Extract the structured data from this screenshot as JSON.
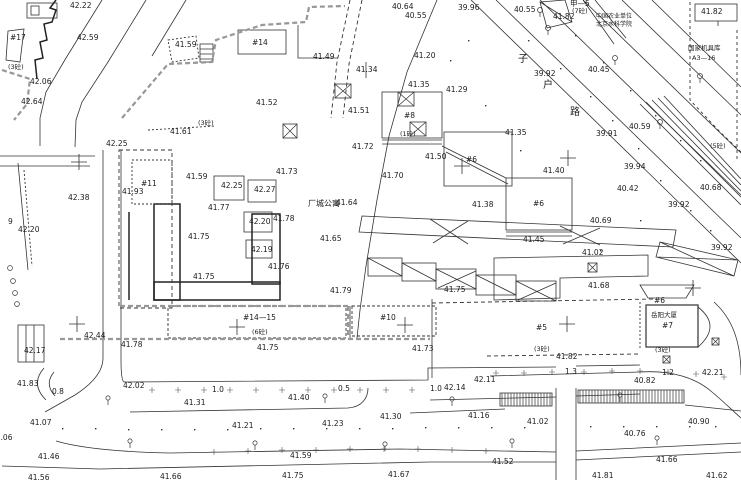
{
  "canvas": {
    "width": 741,
    "height": 480,
    "background": "#ffffff",
    "ink": "#222222"
  },
  "labels": {
    "spots": [
      {
        "t": "42.22",
        "x": 70,
        "y": 2
      },
      {
        "t": "40.64",
        "x": 392,
        "y": 3
      },
      {
        "t": "40.55",
        "x": 405,
        "y": 12
      },
      {
        "t": "39.96",
        "x": 458,
        "y": 4
      },
      {
        "t": "40.55",
        "x": 514,
        "y": 6
      },
      {
        "t": "41.82",
        "x": 553,
        "y": 13
      },
      {
        "t": "41.82",
        "x": 701,
        "y": 8
      },
      {
        "t": "42.59",
        "x": 77,
        "y": 34
      },
      {
        "t": "41.59",
        "x": 175,
        "y": 41
      },
      {
        "t": "42.06",
        "x": 30,
        "y": 78
      },
      {
        "t": "42.64",
        "x": 21,
        "y": 98
      },
      {
        "t": "41.61",
        "x": 170,
        "y": 128
      },
      {
        "t": "42.25",
        "x": 106,
        "y": 140
      },
      {
        "t": "41.49",
        "x": 313,
        "y": 53
      },
      {
        "t": "41.20",
        "x": 414,
        "y": 52
      },
      {
        "t": "41.34",
        "x": 356,
        "y": 66
      },
      {
        "t": "41.35",
        "x": 408,
        "y": 81
      },
      {
        "t": "41.29",
        "x": 446,
        "y": 86
      },
      {
        "t": "41.52",
        "x": 256,
        "y": 99
      },
      {
        "t": "41.51",
        "x": 348,
        "y": 107
      },
      {
        "t": "41.72",
        "x": 352,
        "y": 143
      },
      {
        "t": "41.50",
        "x": 425,
        "y": 153
      },
      {
        "t": "39.92",
        "x": 534,
        "y": 70
      },
      {
        "t": "40.45",
        "x": 588,
        "y": 66
      },
      {
        "t": "41.35",
        "x": 505,
        "y": 129
      },
      {
        "t": "39.91",
        "x": 596,
        "y": 130
      },
      {
        "t": "40.59",
        "x": 629,
        "y": 123
      },
      {
        "t": "41.93",
        "x": 122,
        "y": 188
      },
      {
        "t": "42.38",
        "x": 68,
        "y": 194
      },
      {
        "t": "42.20",
        "x": 18,
        "y": 226
      },
      {
        "t": "41.59",
        "x": 186,
        "y": 173
      },
      {
        "t": "42.25",
        "x": 221,
        "y": 182
      },
      {
        "t": "42.27",
        "x": 254,
        "y": 186
      },
      {
        "t": "41.77",
        "x": 208,
        "y": 204
      },
      {
        "t": "41.73",
        "x": 276,
        "y": 168
      },
      {
        "t": "41.70",
        "x": 382,
        "y": 172
      },
      {
        "t": "41.64",
        "x": 336,
        "y": 199
      },
      {
        "t": "41.78",
        "x": 273,
        "y": 215
      },
      {
        "t": "42.20",
        "x": 249,
        "y": 218
      },
      {
        "t": "42.19",
        "x": 251,
        "y": 246
      },
      {
        "t": "41.65",
        "x": 320,
        "y": 235
      },
      {
        "t": "41.76",
        "x": 268,
        "y": 263
      },
      {
        "t": "41.75",
        "x": 188,
        "y": 233
      },
      {
        "t": "41.75",
        "x": 193,
        "y": 273
      },
      {
        "t": "41.79",
        "x": 330,
        "y": 287
      },
      {
        "t": "41.75",
        "x": 444,
        "y": 286
      },
      {
        "t": "41.38",
        "x": 472,
        "y": 201
      },
      {
        "t": "41.40",
        "x": 543,
        "y": 167
      },
      {
        "t": "41.45",
        "x": 523,
        "y": 236
      },
      {
        "t": "40.69",
        "x": 590,
        "y": 217
      },
      {
        "t": "39.94",
        "x": 624,
        "y": 163
      },
      {
        "t": "40.42",
        "x": 617,
        "y": 185
      },
      {
        "t": "40.68",
        "x": 700,
        "y": 184
      },
      {
        "t": "39.92",
        "x": 668,
        "y": 201
      },
      {
        "t": "39.92",
        "x": 711,
        "y": 244
      },
      {
        "t": "41.02",
        "x": 582,
        "y": 249
      },
      {
        "t": "41.68",
        "x": 588,
        "y": 282
      },
      {
        "t": "42.17",
        "x": 24,
        "y": 347
      },
      {
        "t": "42.44",
        "x": 84,
        "y": 332
      },
      {
        "t": "41.78",
        "x": 121,
        "y": 341
      },
      {
        "t": "41.75",
        "x": 257,
        "y": 344
      },
      {
        "t": "41.73",
        "x": 412,
        "y": 345
      },
      {
        "t": "41.82",
        "x": 556,
        "y": 353
      },
      {
        "t": "41.83",
        "x": 17,
        "y": 380
      },
      {
        "t": "42.02",
        "x": 123,
        "y": 382
      },
      {
        "t": "41.31",
        "x": 184,
        "y": 399
      },
      {
        "t": "41.40",
        "x": 288,
        "y": 394
      },
      {
        "t": "42.14",
        "x": 444,
        "y": 384
      },
      {
        "t": "42.11",
        "x": 474,
        "y": 376
      },
      {
        "t": "40.82",
        "x": 634,
        "y": 377
      },
      {
        "t": "42.21",
        "x": 702,
        "y": 369
      },
      {
        "t": "41.07",
        "x": 30,
        "y": 419
      },
      {
        "t": "41.21",
        "x": 232,
        "y": 422
      },
      {
        "t": "41.23",
        "x": 322,
        "y": 420
      },
      {
        "t": "41.30",
        "x": 380,
        "y": 413
      },
      {
        "t": "41.16",
        "x": 468,
        "y": 412
      },
      {
        "t": "41.02",
        "x": 527,
        "y": 418
      },
      {
        "t": "40.76",
        "x": 624,
        "y": 430
      },
      {
        "t": "40.90",
        "x": 688,
        "y": 418
      },
      {
        "t": "41.06",
        "x": -9,
        "y": 434
      },
      {
        "t": "41.46",
        "x": 38,
        "y": 453
      },
      {
        "t": "41.56",
        "x": 28,
        "y": 474
      },
      {
        "t": "41.66",
        "x": 160,
        "y": 473
      },
      {
        "t": "41.59",
        "x": 290,
        "y": 452
      },
      {
        "t": "41.75",
        "x": 282,
        "y": 472
      },
      {
        "t": "41.67",
        "x": 388,
        "y": 471
      },
      {
        "t": "41.52",
        "x": 492,
        "y": 458
      },
      {
        "t": "41.66",
        "x": 656,
        "y": 456
      },
      {
        "t": "41.81",
        "x": 592,
        "y": 472
      },
      {
        "t": "41.62",
        "x": 706,
        "y": 472
      }
    ],
    "buildings": [
      {
        "t": "#17",
        "x": 10,
        "y": 34
      },
      {
        "t": "#14",
        "x": 252,
        "y": 39
      },
      {
        "t": "#8",
        "x": 404,
        "y": 112
      },
      {
        "t": "#6",
        "x": 466,
        "y": 156
      },
      {
        "t": "#6",
        "x": 533,
        "y": 200
      },
      {
        "t": "#11",
        "x": 141,
        "y": 180
      },
      {
        "t": "#14—15",
        "x": 243,
        "y": 314
      },
      {
        "t": "#10",
        "x": 380,
        "y": 314
      },
      {
        "t": "#5",
        "x": 536,
        "y": 324
      },
      {
        "t": "#7",
        "x": 662,
        "y": 322
      },
      {
        "t": "#6",
        "x": 654,
        "y": 297
      },
      {
        "t": "甲—5",
        "x": 570,
        "y": 0
      }
    ],
    "storeys": [
      {
        "t": "(3砼)",
        "x": 8,
        "y": 64
      },
      {
        "t": "(3砼)",
        "x": 198,
        "y": 120
      },
      {
        "t": "(7砼)",
        "x": 572,
        "y": 8
      },
      {
        "t": "(1砼)",
        "x": 400,
        "y": 131
      },
      {
        "t": "(5砼)",
        "x": 710,
        "y": 143
      },
      {
        "t": "(6砼)",
        "x": 252,
        "y": 329
      },
      {
        "t": "(3砼)",
        "x": 534,
        "y": 346
      },
      {
        "t": "(3砼)",
        "x": 655,
        "y": 347
      }
    ],
    "names": [
      {
        "t": "厂城公寓",
        "x": 308,
        "y": 200,
        "s": 8
      },
      {
        "t": "中国农业单位",
        "x": 596,
        "y": 14,
        "s": 6
      },
      {
        "t": "北京水科学院",
        "x": 596,
        "y": 22,
        "s": 6
      },
      {
        "t": "国家机具库",
        "x": 688,
        "y": 45,
        "s": 6.5
      },
      {
        "t": "A3—16",
        "x": 692,
        "y": 55,
        "s": 6.5
      },
      {
        "t": "岳阳大厦",
        "x": 651,
        "y": 312,
        "s": 6.5
      }
    ],
    "widths": [
      {
        "t": "0.8",
        "x": 52,
        "y": 388
      },
      {
        "t": "1.0",
        "x": 212,
        "y": 386
      },
      {
        "t": "0.5",
        "x": 338,
        "y": 385
      },
      {
        "t": "1.0",
        "x": 430,
        "y": 385
      },
      {
        "t": "1.3",
        "x": 565,
        "y": 368
      },
      {
        "t": "1.2",
        "x": 662,
        "y": 369
      }
    ],
    "road_chars": [
      {
        "t": "子",
        "x": 518,
        "y": 55
      },
      {
        "t": "户",
        "x": 543,
        "y": 81
      },
      {
        "t": "路",
        "x": 570,
        "y": 108
      }
    ],
    "misc": [
      {
        "t": "9",
        "x": 8,
        "y": 218
      }
    ]
  },
  "symbols": {
    "crosses": [
      [
        79,
        162
      ],
      [
        462,
        166
      ],
      [
        568,
        158
      ],
      [
        77,
        324
      ],
      [
        237,
        327
      ],
      [
        405,
        325
      ],
      [
        567,
        324
      ],
      [
        693,
        288
      ]
    ],
    "lamps": [
      [
        108,
        398
      ],
      [
        325,
        396
      ],
      [
        452,
        399
      ],
      [
        620,
        395
      ],
      [
        130,
        441
      ],
      [
        255,
        443
      ],
      [
        385,
        444
      ],
      [
        512,
        441
      ],
      [
        657,
        438
      ]
    ],
    "trees": [
      [
        540,
        10
      ],
      [
        548,
        28
      ],
      [
        700,
        76
      ],
      [
        615,
        58
      ],
      [
        660,
        122
      ]
    ],
    "xboxes": [
      [
        335,
        84,
        16,
        14
      ],
      [
        398,
        92,
        16,
        14
      ],
      [
        410,
        122,
        16,
        14
      ],
      [
        283,
        124,
        14,
        14
      ],
      [
        588,
        263,
        9,
        9
      ],
      [
        712,
        338,
        7,
        7
      ],
      [
        663,
        356,
        7,
        7
      ]
    ],
    "ticks": [
      [
        152,
        390
      ],
      [
        178,
        390
      ],
      [
        204,
        390
      ],
      [
        230,
        390
      ],
      [
        256,
        390
      ],
      [
        282,
        390
      ],
      [
        308,
        390
      ],
      [
        334,
        390
      ],
      [
        360,
        390
      ],
      [
        386,
        390
      ],
      [
        412,
        390
      ],
      [
        496,
        373
      ],
      [
        524,
        373
      ],
      [
        552,
        372
      ],
      [
        584,
        372
      ],
      [
        612,
        371
      ],
      [
        640,
        371
      ],
      [
        668,
        372
      ],
      [
        696,
        374
      ],
      [
        724,
        377
      ],
      [
        214,
        452
      ],
      [
        248,
        451
      ],
      [
        282,
        450
      ],
      [
        316,
        450
      ],
      [
        350,
        449
      ],
      [
        384,
        449
      ],
      [
        418,
        449
      ],
      [
        452,
        450
      ],
      [
        486,
        451
      ]
    ],
    "dots": [
      [
        62,
        428
      ],
      [
        95,
        428
      ],
      [
        128,
        429
      ],
      [
        161,
        429
      ],
      [
        194,
        429
      ],
      [
        227,
        429
      ],
      [
        260,
        428
      ],
      [
        293,
        428
      ],
      [
        326,
        428
      ],
      [
        359,
        428
      ],
      [
        392,
        428
      ],
      [
        425,
        427
      ],
      [
        458,
        427
      ],
      [
        491,
        427
      ],
      [
        524,
        427
      ],
      [
        590,
        426
      ],
      [
        623,
        426
      ],
      [
        656,
        426
      ],
      [
        689,
        426
      ],
      [
        715,
        426
      ],
      [
        528,
        40
      ],
      [
        560,
        68
      ],
      [
        590,
        96
      ],
      [
        612,
        120
      ],
      [
        638,
        148
      ],
      [
        575,
        35
      ],
      [
        603,
        62
      ],
      [
        630,
        90
      ],
      [
        655,
        115
      ],
      [
        680,
        140
      ],
      [
        700,
        160
      ],
      [
        660,
        180
      ],
      [
        690,
        210
      ],
      [
        710,
        230
      ],
      [
        450,
        60
      ],
      [
        468,
        40
      ],
      [
        485,
        105
      ],
      [
        520,
        150
      ],
      [
        600,
        250
      ],
      [
        640,
        220
      ]
    ],
    "circles": [
      [
        10,
        268
      ],
      [
        13,
        281
      ],
      [
        15,
        293
      ],
      [
        17,
        304
      ]
    ]
  }
}
